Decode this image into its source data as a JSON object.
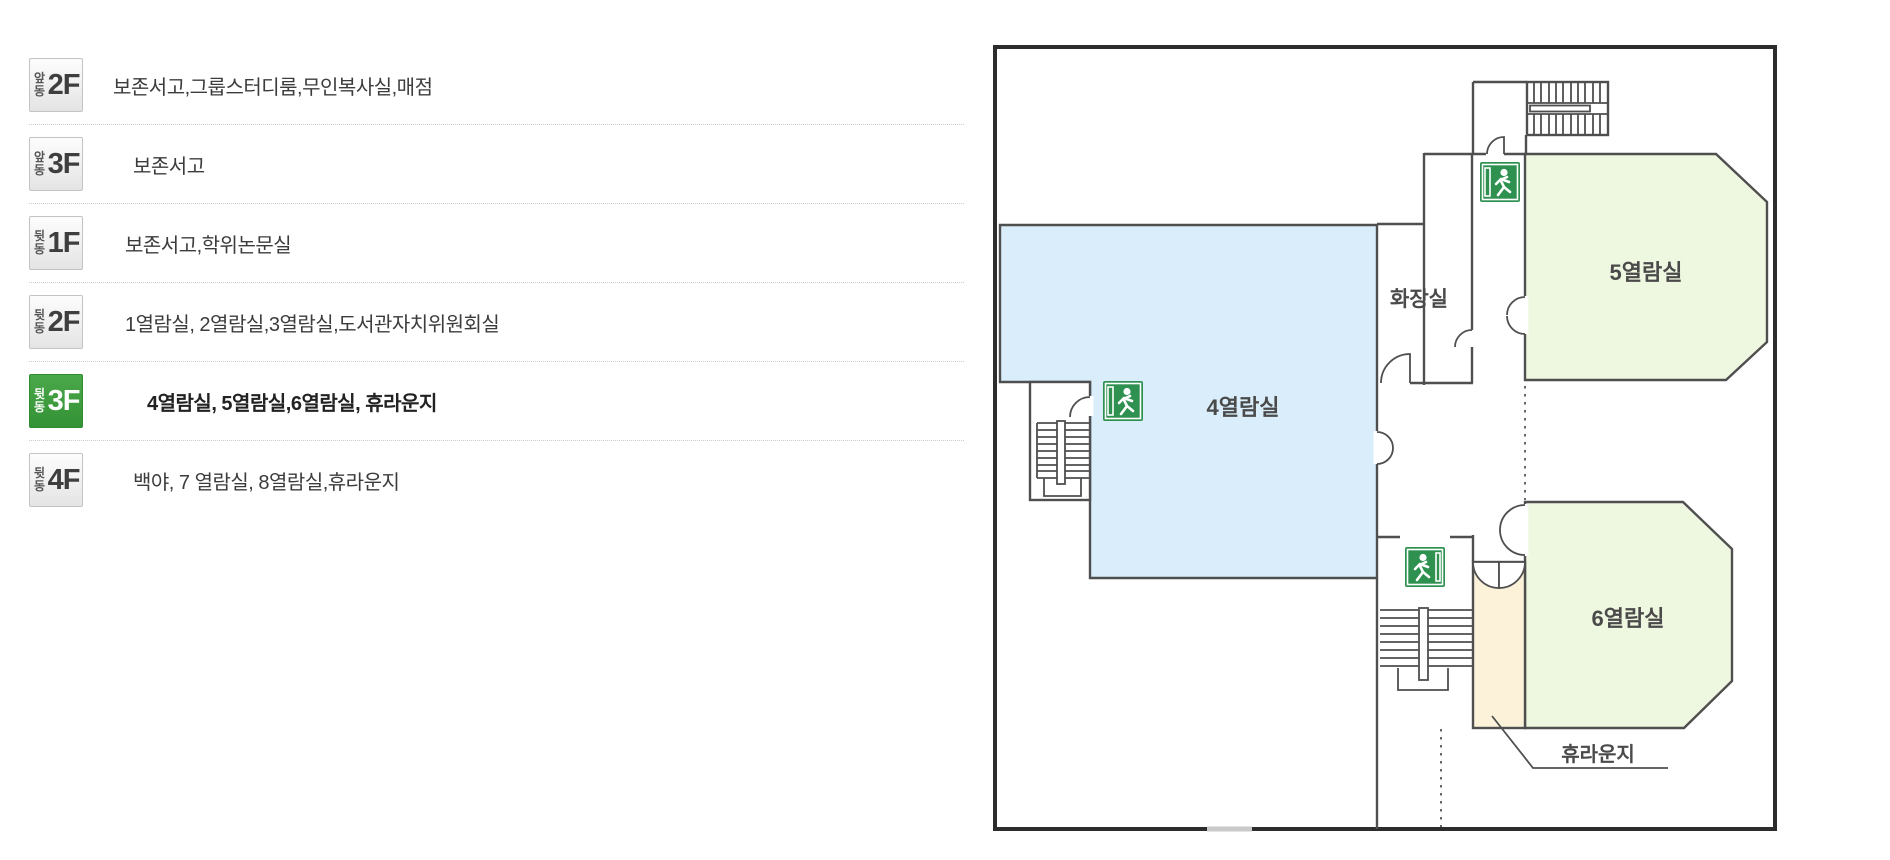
{
  "floor_list": {
    "rows": [
      {
        "building": "앞동",
        "floor": "2F",
        "rooms": "보존서고,그룹스터디룸,무인복사실,매점"
      },
      {
        "building": "앞동",
        "floor": "3F",
        "rooms": "보존서고"
      },
      {
        "building": "뒷동",
        "floor": "1F",
        "rooms": "보존서고,학위논문실"
      },
      {
        "building": "뒷동",
        "floor": "2F",
        "rooms": "1열람실, 2열람실,3열람실,도서관자치위원회실"
      },
      {
        "building": "뒷동",
        "floor": "3F",
        "rooms": "4열람실, 5열람실,6열람실, 휴라운지",
        "active": true
      },
      {
        "building": "뒷동",
        "floor": "4F",
        "rooms": "백야, 7 열람실, 8열람실,휴라운지"
      }
    ],
    "active_color": "#3f9b41"
  },
  "floor_plan": {
    "labels": {
      "reading4": "4열람실",
      "reading5": "5열람실",
      "reading6": "6열람실",
      "restroom": "화장실",
      "lounge": "휴라운지"
    },
    "colors": {
      "reading4_fill": "#d9eefa",
      "reading_green_fill": "#eef7df",
      "lounge_fill": "#fbf2d9",
      "wall": "#4f4f4f",
      "exit_green": "#2e9150"
    }
  }
}
